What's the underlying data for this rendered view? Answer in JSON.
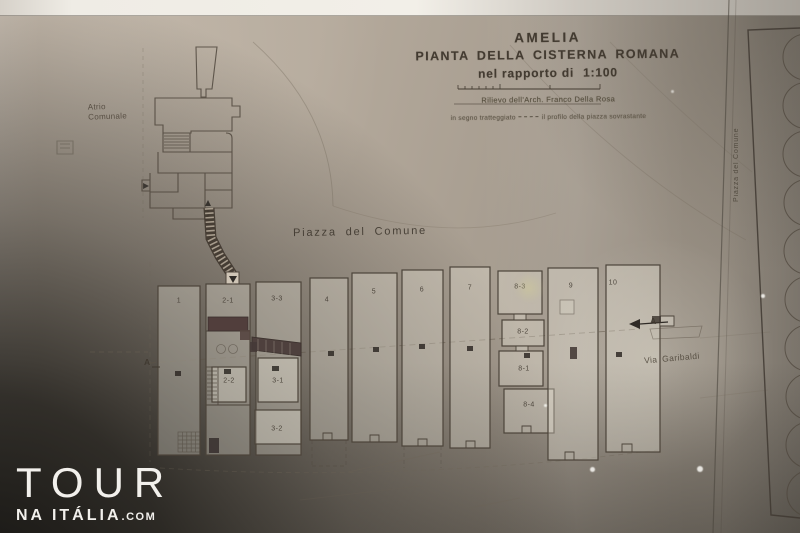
{
  "title_block": {
    "city": "AMELIA",
    "subtitle": "PIANTA DELLA CISTERNA ROMANA",
    "scale_prefix": "nel rapporto di",
    "scale_value": "1:100",
    "credit": "Rilievo dell'Arch. Franco Della Rosa",
    "legend_prefix": "in segno tratteggiato",
    "legend_suffix": "il profilo della piazza sovrastante"
  },
  "labels": {
    "atrio_line1": "Atrio",
    "atrio_line2": "Comunale",
    "piazza": "Piazza del Comune",
    "via_garibaldi": "Via Garibaldi",
    "piazza_vertical": "Piazza del Comune",
    "section_left": "A",
    "section_right": "A"
  },
  "chambers": [
    {
      "label": "1"
    },
    {
      "label": "2-1"
    },
    {
      "label": "3-3"
    },
    {
      "label": "4"
    },
    {
      "label": "5"
    },
    {
      "label": "6"
    },
    {
      "label": "7"
    },
    {
      "label": "8-3"
    },
    {
      "label": "9"
    },
    {
      "label": "10"
    },
    {
      "label": "2-2"
    },
    {
      "label": "3-1"
    },
    {
      "label": "3-2"
    },
    {
      "label": "8-2"
    },
    {
      "label": "8-1"
    },
    {
      "label": "8-4"
    }
  ],
  "watermark": {
    "brand": "TOUR",
    "sub": "NA ITÁLIA",
    "suffix": ".COM"
  },
  "colors": {
    "ink": "#4c443a",
    "paper": "#b5aa9c",
    "dark_wall_fill": "#4a3c38",
    "watermark_text": "#f2f0ec"
  }
}
